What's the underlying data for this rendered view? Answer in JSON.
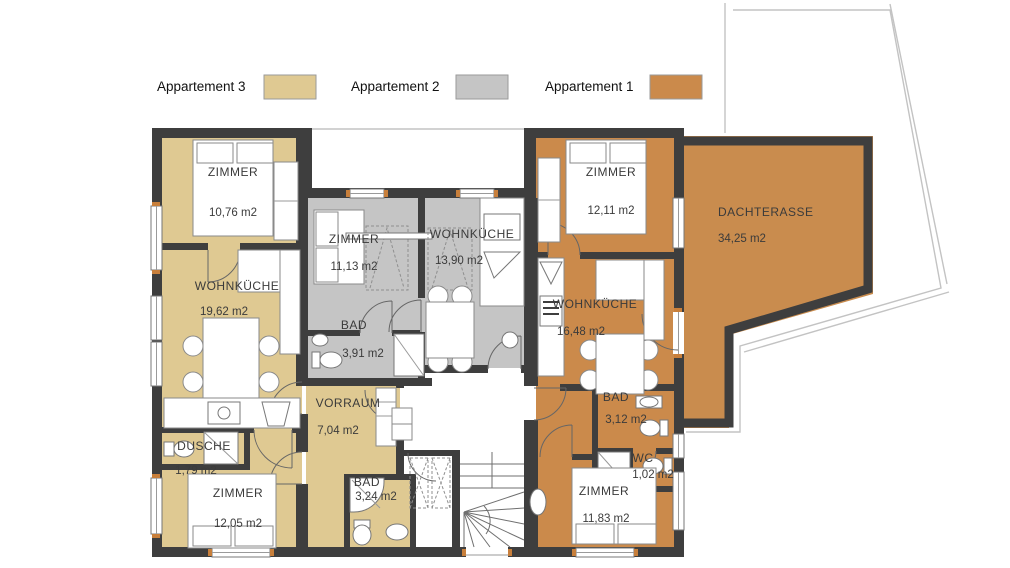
{
  "legend": {
    "title": "Apartment colour legend",
    "items_note": "three apartments distinguished by fill colour"
  },
  "colors": {
    "appartement_3": "#DFC992",
    "appartement_2": "#C5C5C5",
    "appartement_1": "#CB8A4B",
    "terrace": "#C98C4E",
    "wall": "#3E3E3E",
    "opening_tick": "#C87F3B"
  },
  "apartments": {
    "appartement_3": {
      "label": "Appartement 3",
      "rooms": {
        "zimmer_nw": {
          "name": "ZIMMER",
          "area": "10,76 m2"
        },
        "wohnkueche": {
          "name": "WOHNKÜCHE",
          "area": "19,62 m2"
        },
        "dusche": {
          "name": "DUSCHE",
          "area": "1,79 m2"
        },
        "zimmer_sw": {
          "name": "ZIMMER",
          "area": "12,05 m2"
        },
        "vorraum": {
          "name": "VORRAUM",
          "area": "7,04 m2"
        },
        "bad": {
          "name": "BAD",
          "area": "3,24 m2"
        }
      }
    },
    "appartement_2": {
      "label": "Appartement 2",
      "rooms": {
        "zimmer": {
          "name": "ZIMMER",
          "area": "11,13 m2"
        },
        "wohnkueche": {
          "name": "WOHNKÜCHE",
          "area": "13,90 m2"
        },
        "bad": {
          "name": "BAD",
          "area": "3,91 m2"
        }
      }
    },
    "appartement_1": {
      "label": "Appartement 1",
      "rooms": {
        "zimmer_n": {
          "name": "ZIMMER",
          "area": "12,11 m2"
        },
        "wohnkueche": {
          "name": "WOHNKÜCHE",
          "area": "16,48 m2"
        },
        "bad": {
          "name": "BAD",
          "area": "3,12 m2"
        },
        "wc": {
          "name": "WC",
          "area": "1,02 m2"
        },
        "zimmer_s": {
          "name": "ZIMMER",
          "area": "11,83 m2"
        },
        "dachterasse": {
          "name": "DACHTERASSE",
          "area": "34,25 m2"
        }
      }
    }
  }
}
